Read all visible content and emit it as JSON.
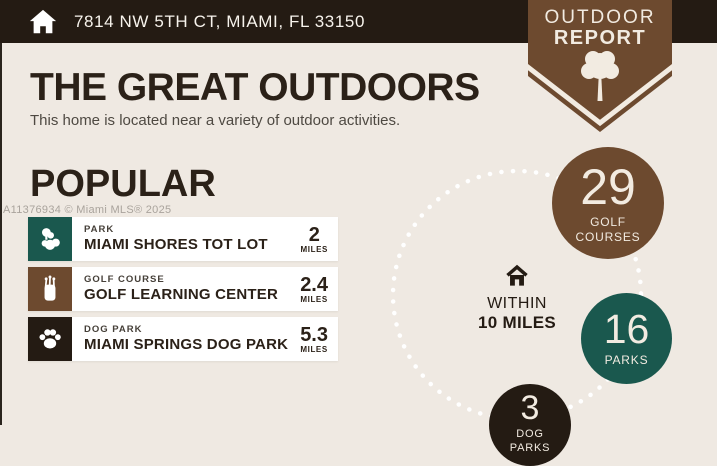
{
  "top_bar": {
    "address": "7814 NW 5TH CT, MIAMI, FL 33150",
    "icon": "home-icon",
    "bg_color": "#241b13"
  },
  "badge": {
    "line1": "OUTDOOR",
    "line2": "REPORT",
    "icon": "tree-icon",
    "color": "#6d4a2f"
  },
  "header": {
    "title": "THE GREAT OUTDOORS",
    "subtitle": "This home is located near a variety of outdoor activities."
  },
  "watermark": "A11376934 © Miami MLS® 2025",
  "popular": {
    "heading": "POPULAR",
    "items": [
      {
        "category": "PARK",
        "name": "MIAMI SHORES TOT LOT",
        "distance": "2",
        "unit": "MILES",
        "icon": "park-trees-icon",
        "icon_bg": "#1a584e"
      },
      {
        "category": "GOLF COURSE",
        "name": "GOLF LEARNING CENTER",
        "distance": "2.4",
        "unit": "MILES",
        "icon": "golf-bag-icon",
        "icon_bg": "#6d4a2f"
      },
      {
        "category": "DOG PARK",
        "name": "MIAMI SPRINGS DOG PARK",
        "distance": "5.3",
        "unit": "MILES",
        "icon": "paw-icon",
        "icon_bg": "#241b13"
      }
    ]
  },
  "radius": {
    "line1": "WITHIN",
    "line2": "10 MILES",
    "icon": "home-outline-icon"
  },
  "stats": [
    {
      "value": "29",
      "label": "GOLF COURSES",
      "color": "#6d4a2f"
    },
    {
      "value": "16",
      "label": "PARKS",
      "color": "#1a584e"
    },
    {
      "value": "3",
      "label": "DOG PARKS",
      "color": "#241b13"
    }
  ],
  "colors": {
    "background": "#efe9e2",
    "bar": "#241b13",
    "brown": "#6d4a2f",
    "teal": "#1a584e",
    "dark": "#241b13",
    "cream_text": "#f2ebe1",
    "heading_text": "#2b2118"
  }
}
